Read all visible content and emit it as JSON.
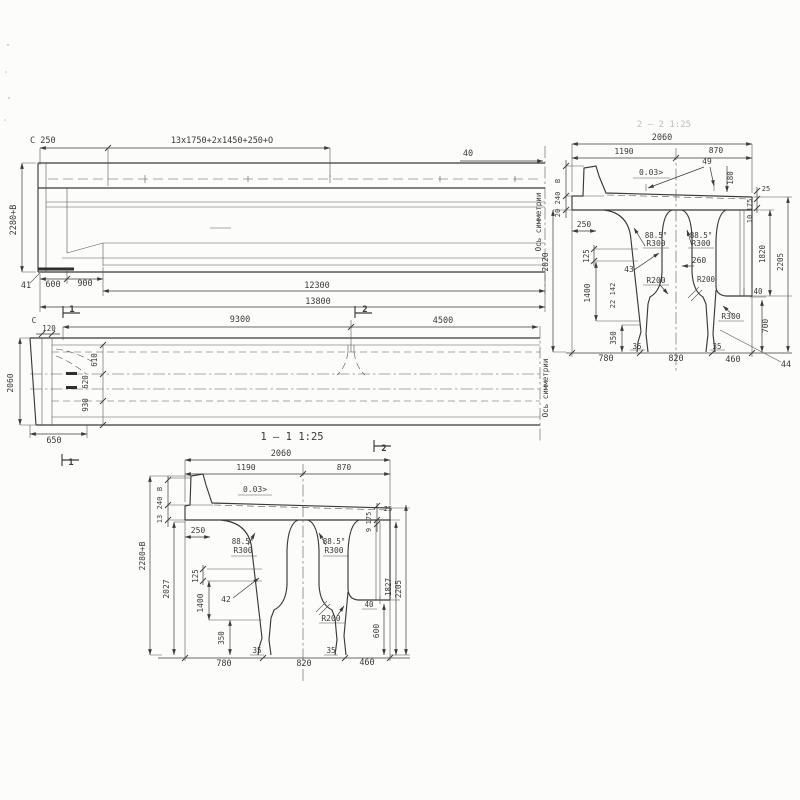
{
  "sheet": {
    "bg": "#fcfcfa",
    "ink": "#3a3a3a"
  },
  "elevation": {
    "dim_c250": "C 250",
    "dim_spacing": "13x1750+2x1450+250+O",
    "dim_40": "40",
    "dim_height": "2280+B",
    "dim_41": "41",
    "dim_600": "600",
    "dim_900": "900",
    "dim_12300": "12300",
    "dim_13800": "13800",
    "axis_label": "Ось симметрии"
  },
  "section2": {
    "title": "2 — 2 1:25",
    "dim_2060": "2060",
    "dim_1190": "1190",
    "dim_870": "870",
    "slope": "0.03>",
    "dim_49": "49",
    "dim_180": "180",
    "dim_b": "B",
    "dim_240": "240",
    "dim_20": "20",
    "dim_250": "250",
    "dim_2020": "2020",
    "dim_125": "125",
    "dim_43": "43",
    "dim_142": "142",
    "dim_22": "22",
    "dim_1400": "1400",
    "dim_350": "350",
    "angle_left": "88.5°",
    "radius_left": "R300",
    "angle_right": "88.5°",
    "radius_right": "R300",
    "dim_260": "260",
    "r200_left": "R200",
    "r200_right": "R200",
    "r300_bottom": "R300",
    "dim_40": "40",
    "dim_700": "700",
    "dim_25": "25",
    "dim_175": "175",
    "dim_10": "10",
    "dim_1820": "1820",
    "dim_2205": "2205",
    "dim_35_left": "35",
    "dim_35_right": "35",
    "dim_780": "780",
    "dim_820": "820",
    "dim_460": "460",
    "dim_44": "44"
  },
  "plan": {
    "mark_1_top": "1",
    "mark_2_top": "2",
    "mark_2_bottom": "2",
    "mark_1_bottom": "1",
    "dim_9300": "9300",
    "dim_4500": "4500",
    "dim_c": "C",
    "dim_120": "120",
    "dim_2060": "2060",
    "dim_610": "610",
    "dim_620": "620",
    "dim_930": "930",
    "dim_650": "650",
    "axis_label": "Ось симметрии"
  },
  "section1": {
    "title": "1 — 1 1:25",
    "dim_2060": "2060",
    "dim_1190": "1190",
    "dim_870": "870",
    "slope": "0.03>",
    "dim_b": "B",
    "dim_240": "240",
    "dim_13": "13",
    "dim_250": "250",
    "dim_2280": "2280+B",
    "dim_2027": "2027",
    "angle_left": "88.5°",
    "radius_left": "R300",
    "angle_right": "88.5°",
    "radius_right": "R300",
    "dim_125": "125",
    "dim_42": "42",
    "dim_1400": "1400",
    "dim_350": "350",
    "r200": "R200",
    "dim_40": "40",
    "dim_600": "600",
    "dim_25": "25",
    "dim_175": "175",
    "dim_9": "9",
    "dim_1827": "1827",
    "dim_2205": "2205",
    "dim_35_left": "35",
    "dim_35_right": "35",
    "dim_780": "780",
    "dim_820": "820",
    "dim_460": "460"
  }
}
